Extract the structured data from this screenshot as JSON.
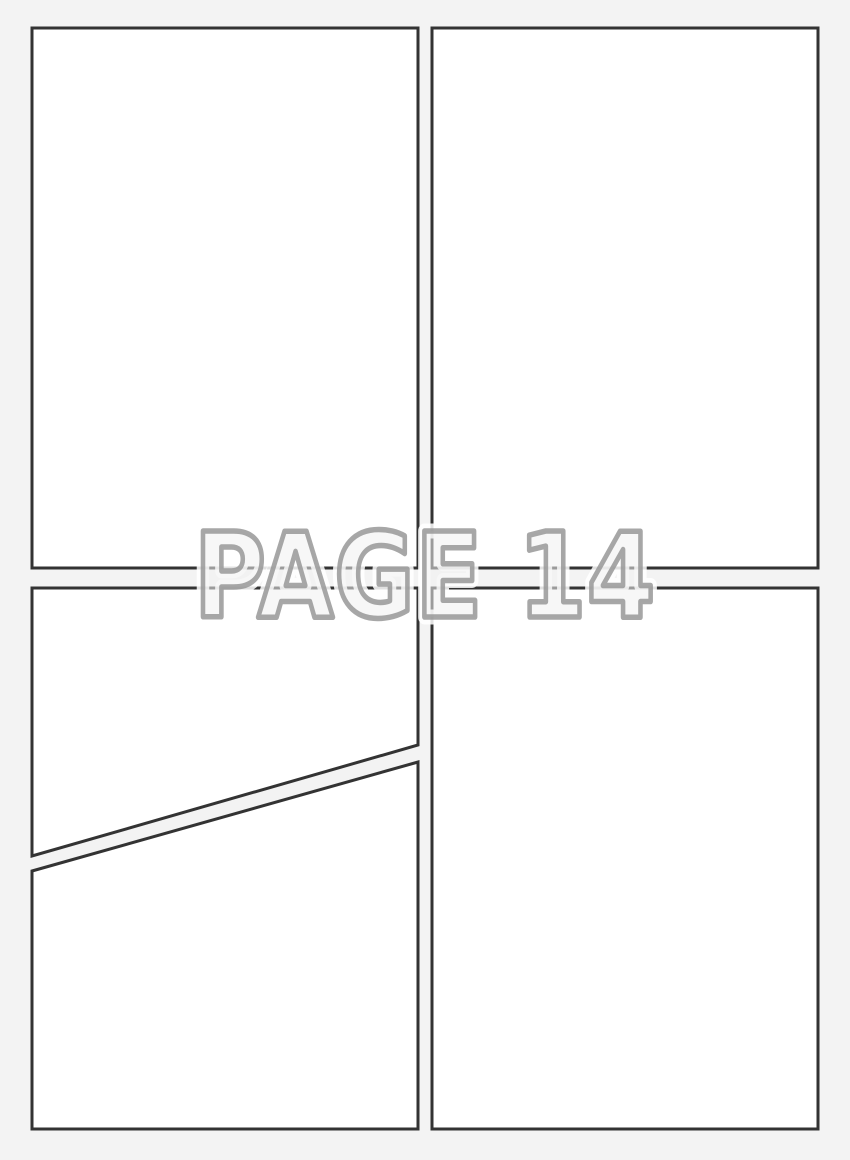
{
  "page": {
    "label": "PAGE 14"
  },
  "colors": {
    "background": "#f3f3f3",
    "panel_fill": "#ffffff",
    "panel_border": "#333333",
    "label_fill": "#f0f0f0",
    "label_outline": "#919191",
    "label_halo": "#ffffff"
  }
}
